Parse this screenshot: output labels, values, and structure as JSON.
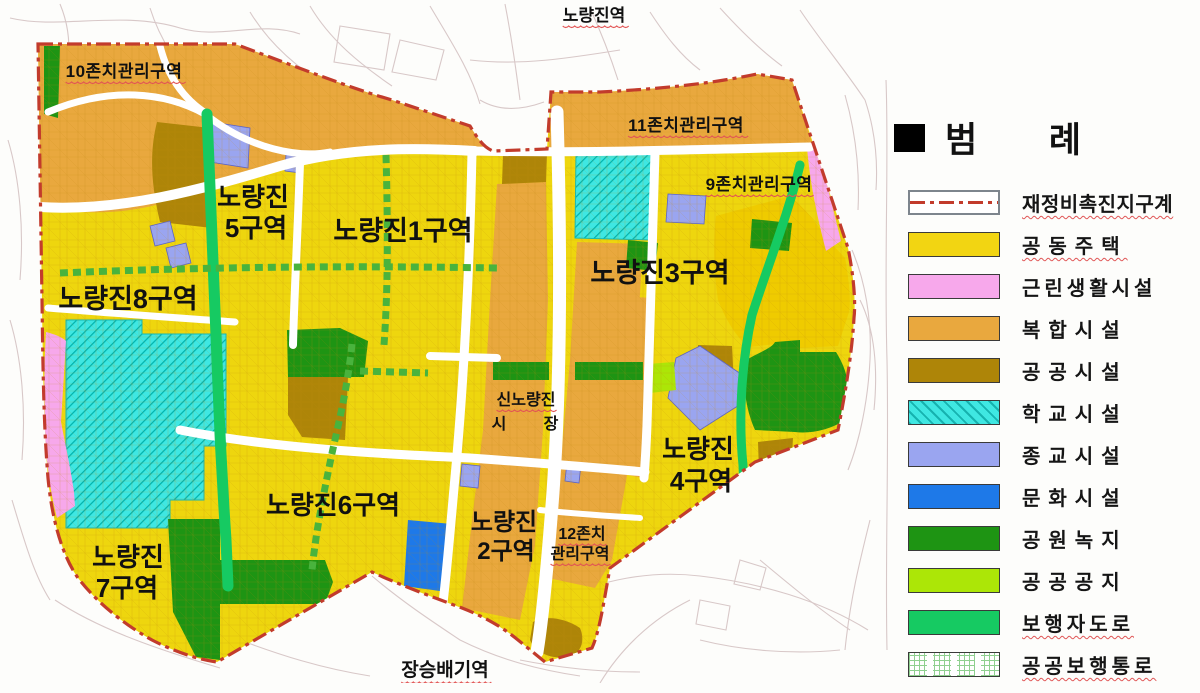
{
  "legend": {
    "title": "범 례",
    "items": [
      {
        "key": "boundary",
        "label": "재정비촉진지구계",
        "type": "line",
        "color": "#C23B2C",
        "underline": true
      },
      {
        "key": "housing",
        "label": "공동주택",
        "type": "fill",
        "color": "#F2D512",
        "underline": true
      },
      {
        "key": "neighborhood",
        "label": "근린생활시설",
        "type": "fill",
        "color": "#F7A8EB",
        "underline": false
      },
      {
        "key": "mixed",
        "label": "복합시설",
        "type": "fill",
        "color": "#E9A83E",
        "underline": false
      },
      {
        "key": "public",
        "label": "공공시설",
        "type": "fill",
        "color": "#AE8508",
        "underline": false
      },
      {
        "key": "school",
        "label": "학교시설",
        "type": "hatch",
        "color": "#3FE7E2",
        "underline": false
      },
      {
        "key": "religious",
        "label": "종교시설",
        "type": "fill",
        "color": "#9AA5F0",
        "underline": false
      },
      {
        "key": "cultural",
        "label": "문화시설",
        "type": "fill",
        "color": "#1E79E8",
        "underline": false
      },
      {
        "key": "park",
        "label": "공원녹지",
        "type": "fill",
        "color": "#1E9413",
        "underline": false
      },
      {
        "key": "open",
        "label": "공공공지",
        "type": "fill",
        "color": "#ACE607",
        "underline": false
      },
      {
        "key": "pedestrian",
        "label": "보행자도로",
        "type": "fill",
        "color": "#16CA62",
        "underline": true
      },
      {
        "key": "passage",
        "label": "공공보행통로",
        "type": "grid",
        "color": "#8FD08F",
        "underline": true
      }
    ]
  },
  "map": {
    "stations": {
      "north": "노량진역",
      "south": "장승배기역"
    },
    "zones": {
      "z1": "노량진1구역",
      "z2a": "노량진",
      "z2b": "2구역",
      "z3": "노량진3구역",
      "z4a": "노량진",
      "z4b": "4구역",
      "z5a": "노량진",
      "z5b": "5구역",
      "z6": "노량진6구역",
      "z7a": "노량진",
      "z7b": "7구역",
      "z8": "노량진8구역"
    },
    "management": {
      "m10": "10존치관리구역",
      "m11": "11존치관리구역",
      "m9": "9존치관리구역",
      "m12a": "12존치",
      "m12b": "관리구역"
    },
    "market": {
      "line1": "신노량진",
      "l2a": "시",
      "l2b": "장"
    }
  },
  "map_colors": {
    "base": "#EED60E",
    "gold": "#EFCB00",
    "texture": "#C08A10",
    "boundary": "#B43126",
    "road": "#FFFFFF",
    "dash_green": "#49B33D",
    "hatch_teal": "#00B2AC",
    "outside": "#D8C8C8"
  }
}
